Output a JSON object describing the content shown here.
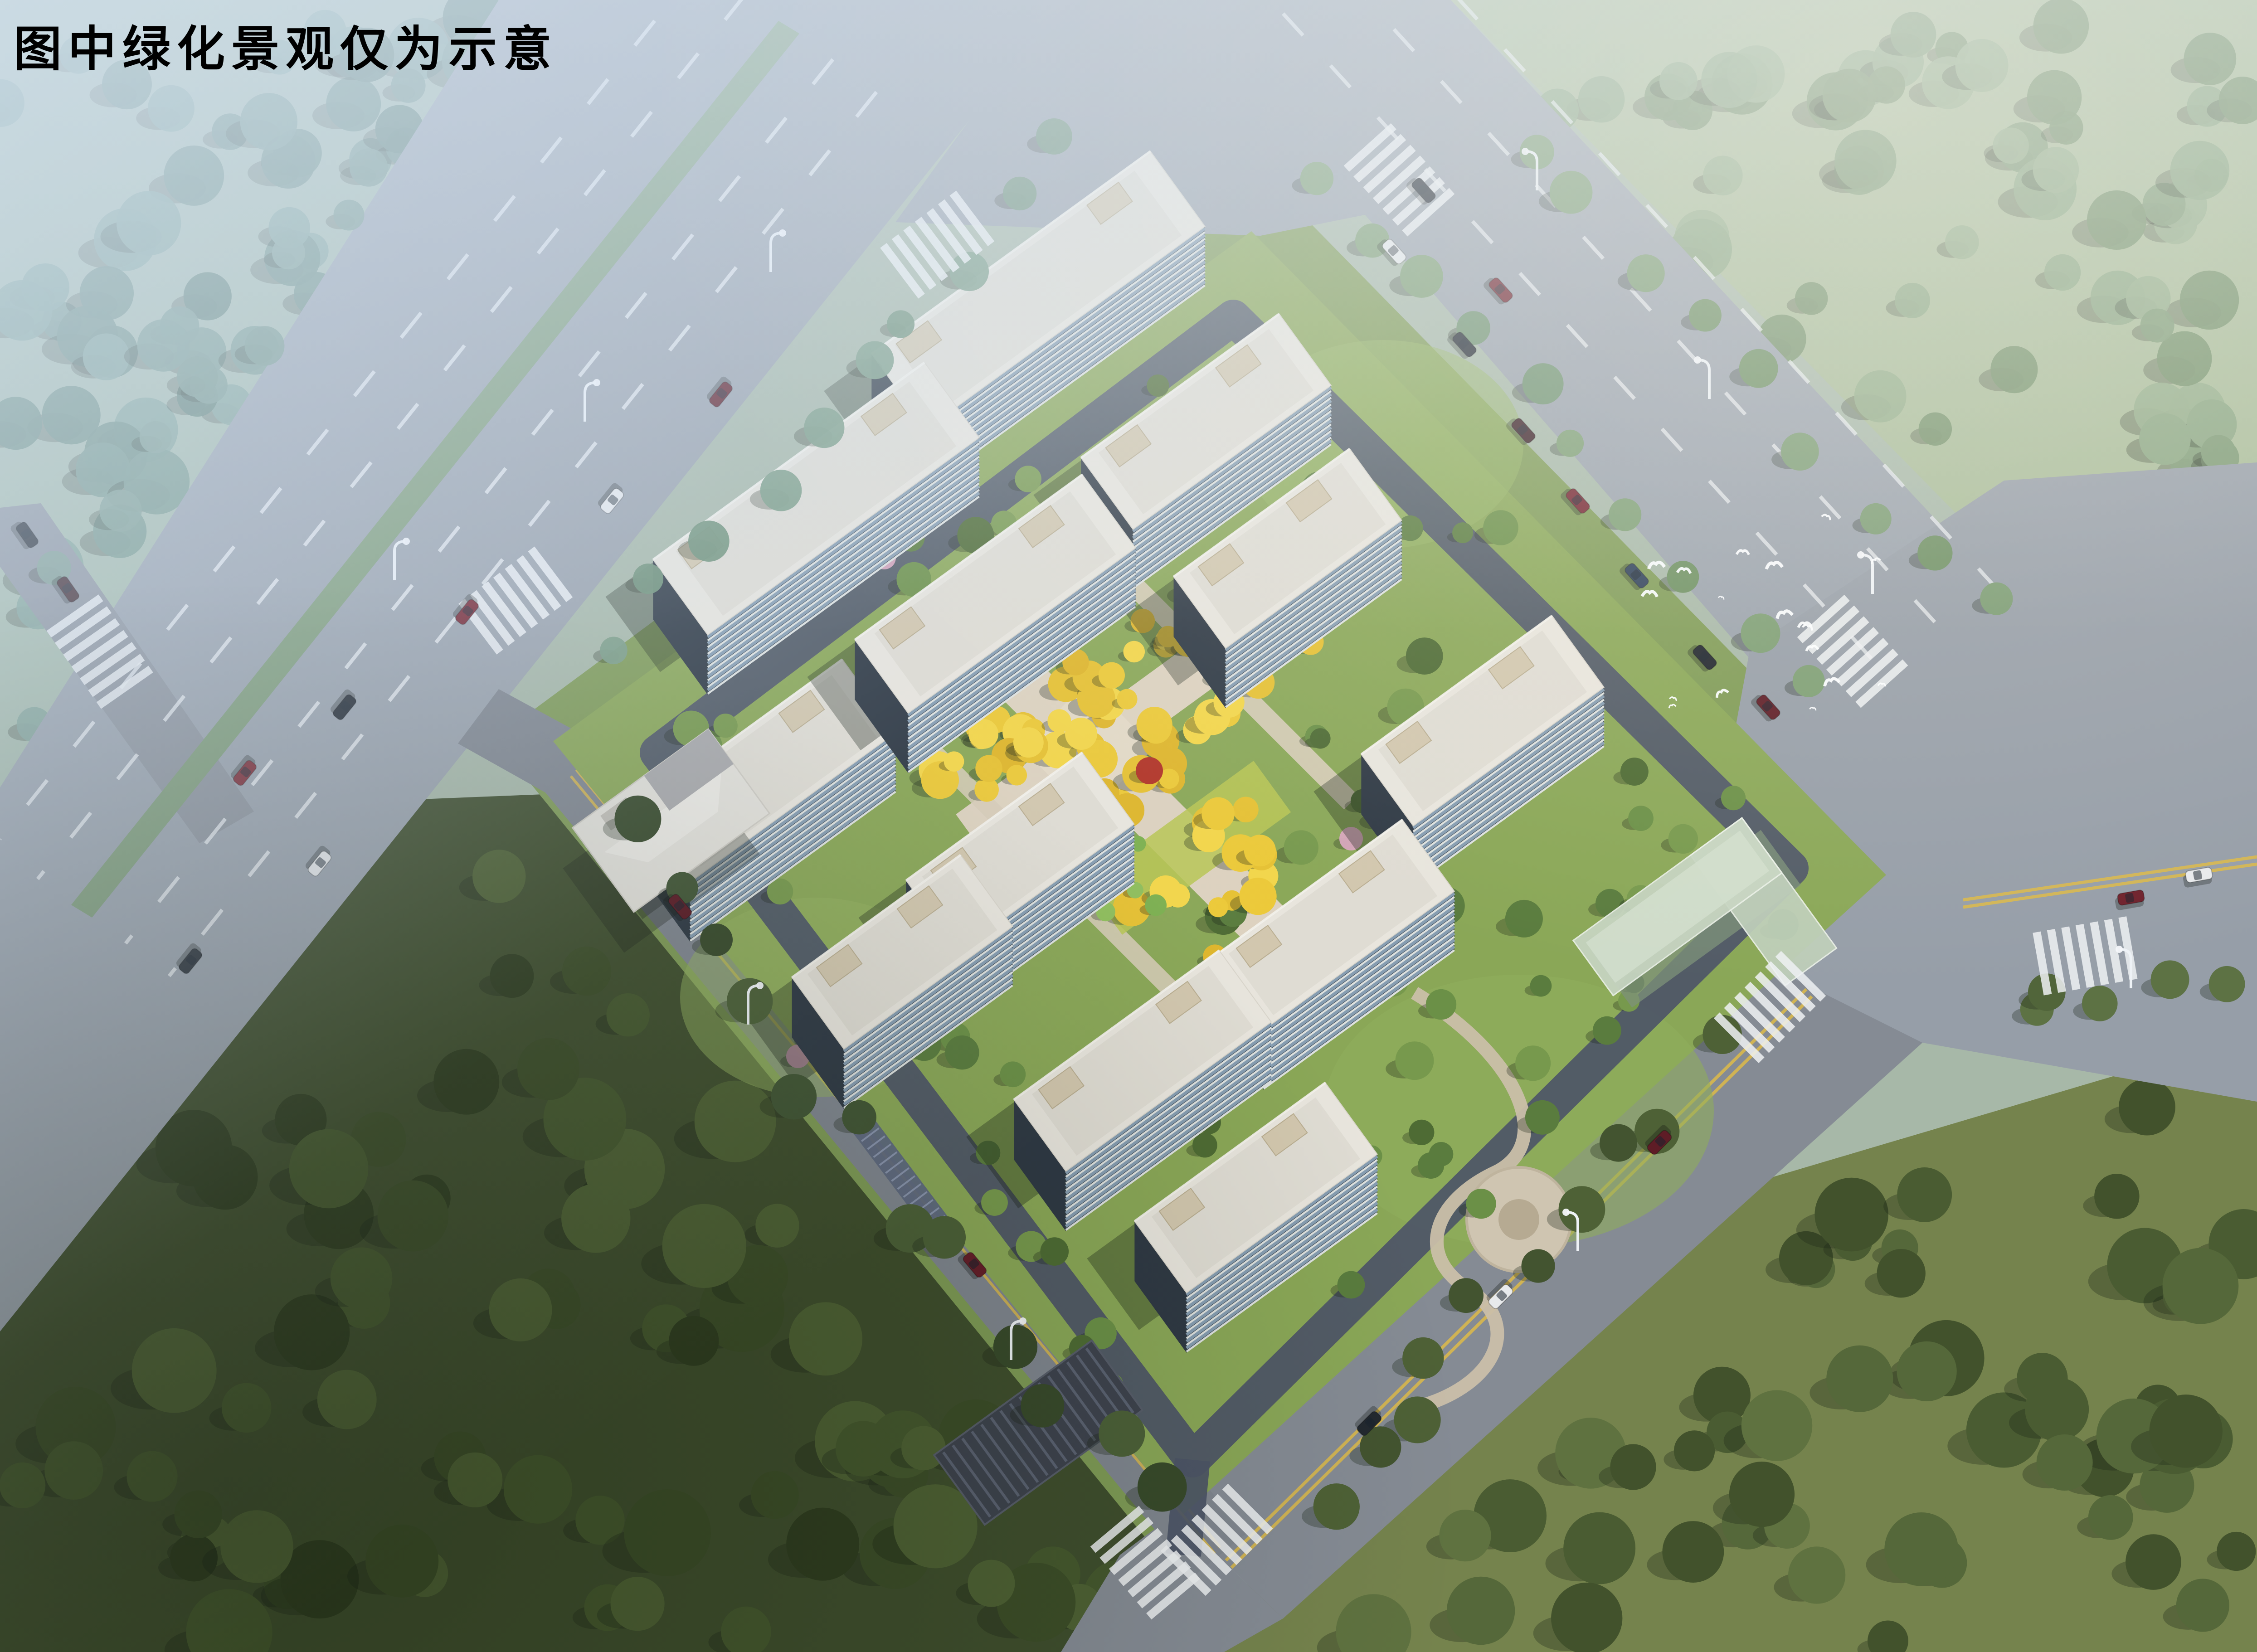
{
  "caption": {
    "text": "图中绿化景观仅为示意"
  },
  "scene": {
    "type": "aerial-architectural-rendering",
    "subject": "residential-community-masterplan",
    "residential_buildings": 12,
    "landmarks": {
      "community_center": "west corner low building",
      "entrance_pavilion": "south gate dark striped roof",
      "l_shaped_building": "east pale-green glass annex",
      "central_garden": "golden tree promenade with cross plaza"
    },
    "counts": {
      "birds": 18,
      "cars": 25,
      "crosswalks": 9,
      "street_lamps": 10
    },
    "colors": {
      "haze": "#cfdcea",
      "road": "#9aa2ac",
      "road_south": "#858b94",
      "lawn": "#8aa757",
      "verge": "#7f9b56",
      "forest_dark": "#3f4e2d",
      "meadow_olive": "#75834d",
      "meadow_hazy": "#a9bc98",
      "tree_hazy": "#7e9f90",
      "tree_dark": "#425431",
      "tree_yellow": "#ecc938",
      "tree_green": "#7db050",
      "building_roof": "#e8e5dd",
      "building_facade": "#3c4652",
      "building_glass": "#8fa7bc",
      "glass_building": "#c7d5c2",
      "path": "#ddd2bf",
      "ring_road": "#4d5567",
      "lane_yellow": "#d9b84e",
      "median_green": "#7d9b76",
      "bird_white": "#fbfdff"
    }
  }
}
